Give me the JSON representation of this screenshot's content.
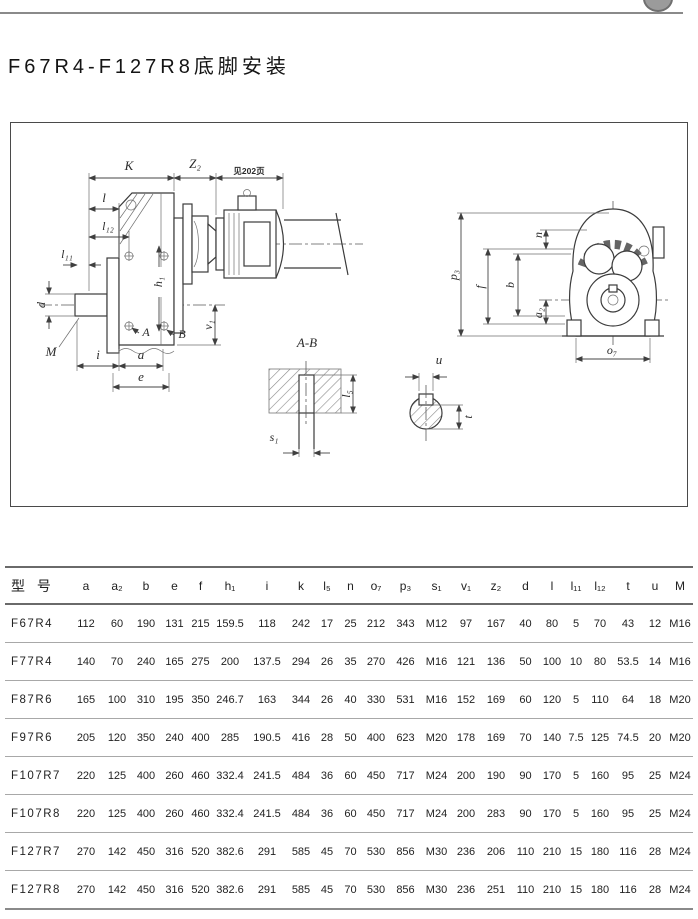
{
  "page": {
    "title": "F67R4-F127R8底脚安装"
  },
  "colors": {
    "line": "#3b3b3b",
    "top_rule": "#8a8a8a",
    "table_rule": "#6a6a6a",
    "text": "#1f1f1f"
  },
  "drawing": {
    "side_view": {
      "k": "K",
      "z2": "Z₂",
      "see_page": "见202页",
      "l": "l",
      "l12": "l₁₂",
      "l11": "l₁₁",
      "d": "d",
      "m": "M",
      "h1": "h₁",
      "a_mark": "A",
      "b_mark": "B",
      "v1": "v₁",
      "i": "i",
      "a": "a",
      "e": "e"
    },
    "section_ab": {
      "title": "A-B",
      "s1": "s₁",
      "l5": "l₅"
    },
    "shaft_section": {
      "u": "u",
      "t": "t"
    },
    "front_view": {
      "p3": "p₃",
      "f": "f",
      "b": "b",
      "n": "n",
      "a2": "a₂",
      "o7": "o₇"
    }
  },
  "table": {
    "headers": [
      "型 号",
      "a",
      "a₂",
      "b",
      "e",
      "f",
      "h₁",
      "i",
      "k",
      "l₅",
      "n",
      "o₇",
      "p₃",
      "s₁",
      "v₁",
      "z₂",
      "d",
      "l",
      "l₁₁",
      "l₁₂",
      "t",
      "u",
      "M"
    ],
    "rows": [
      {
        "model": "F67R4",
        "values": [
          "112",
          "60",
          "190",
          "131",
          "215",
          "159.5",
          "118",
          "242",
          "17",
          "25",
          "212",
          "343",
          "M12",
          "97",
          "167",
          "40",
          "80",
          "5",
          "70",
          "43",
          "12",
          "M16"
        ]
      },
      {
        "model": "F77R4",
        "values": [
          "140",
          "70",
          "240",
          "165",
          "275",
          "200",
          "137.5",
          "294",
          "26",
          "35",
          "270",
          "426",
          "M16",
          "121",
          "136",
          "50",
          "100",
          "10",
          "80",
          "53.5",
          "14",
          "M16"
        ]
      },
      {
        "model": "F87R6",
        "values": [
          "165",
          "100",
          "310",
          "195",
          "350",
          "246.7",
          "163",
          "344",
          "26",
          "40",
          "330",
          "531",
          "M16",
          "152",
          "169",
          "60",
          "120",
          "5",
          "110",
          "64",
          "18",
          "M20"
        ]
      },
      {
        "model": "F97R6",
        "values": [
          "205",
          "120",
          "350",
          "240",
          "400",
          "285",
          "190.5",
          "416",
          "28",
          "50",
          "400",
          "623",
          "M20",
          "178",
          "169",
          "70",
          "140",
          "7.5",
          "125",
          "74.5",
          "20",
          "M20"
        ]
      },
      {
        "model": "F107R7",
        "values": [
          "220",
          "125",
          "400",
          "260",
          "460",
          "332.4",
          "241.5",
          "484",
          "36",
          "60",
          "450",
          "717",
          "M24",
          "200",
          "190",
          "90",
          "170",
          "5",
          "160",
          "95",
          "25",
          "M24"
        ]
      },
      {
        "model": "F107R8",
        "values": [
          "220",
          "125",
          "400",
          "260",
          "460",
          "332.4",
          "241.5",
          "484",
          "36",
          "60",
          "450",
          "717",
          "M24",
          "200",
          "283",
          "90",
          "170",
          "5",
          "160",
          "95",
          "25",
          "M24"
        ]
      },
      {
        "model": "F127R7",
        "values": [
          "270",
          "142",
          "450",
          "316",
          "520",
          "382.6",
          "291",
          "585",
          "45",
          "70",
          "530",
          "856",
          "M30",
          "236",
          "206",
          "110",
          "210",
          "15",
          "180",
          "116",
          "28",
          "M24"
        ]
      },
      {
        "model": "F127R8",
        "values": [
          "270",
          "142",
          "450",
          "316",
          "520",
          "382.6",
          "291",
          "585",
          "45",
          "70",
          "530",
          "856",
          "M30",
          "236",
          "251",
          "110",
          "210",
          "15",
          "180",
          "116",
          "28",
          "M24"
        ]
      }
    ]
  }
}
